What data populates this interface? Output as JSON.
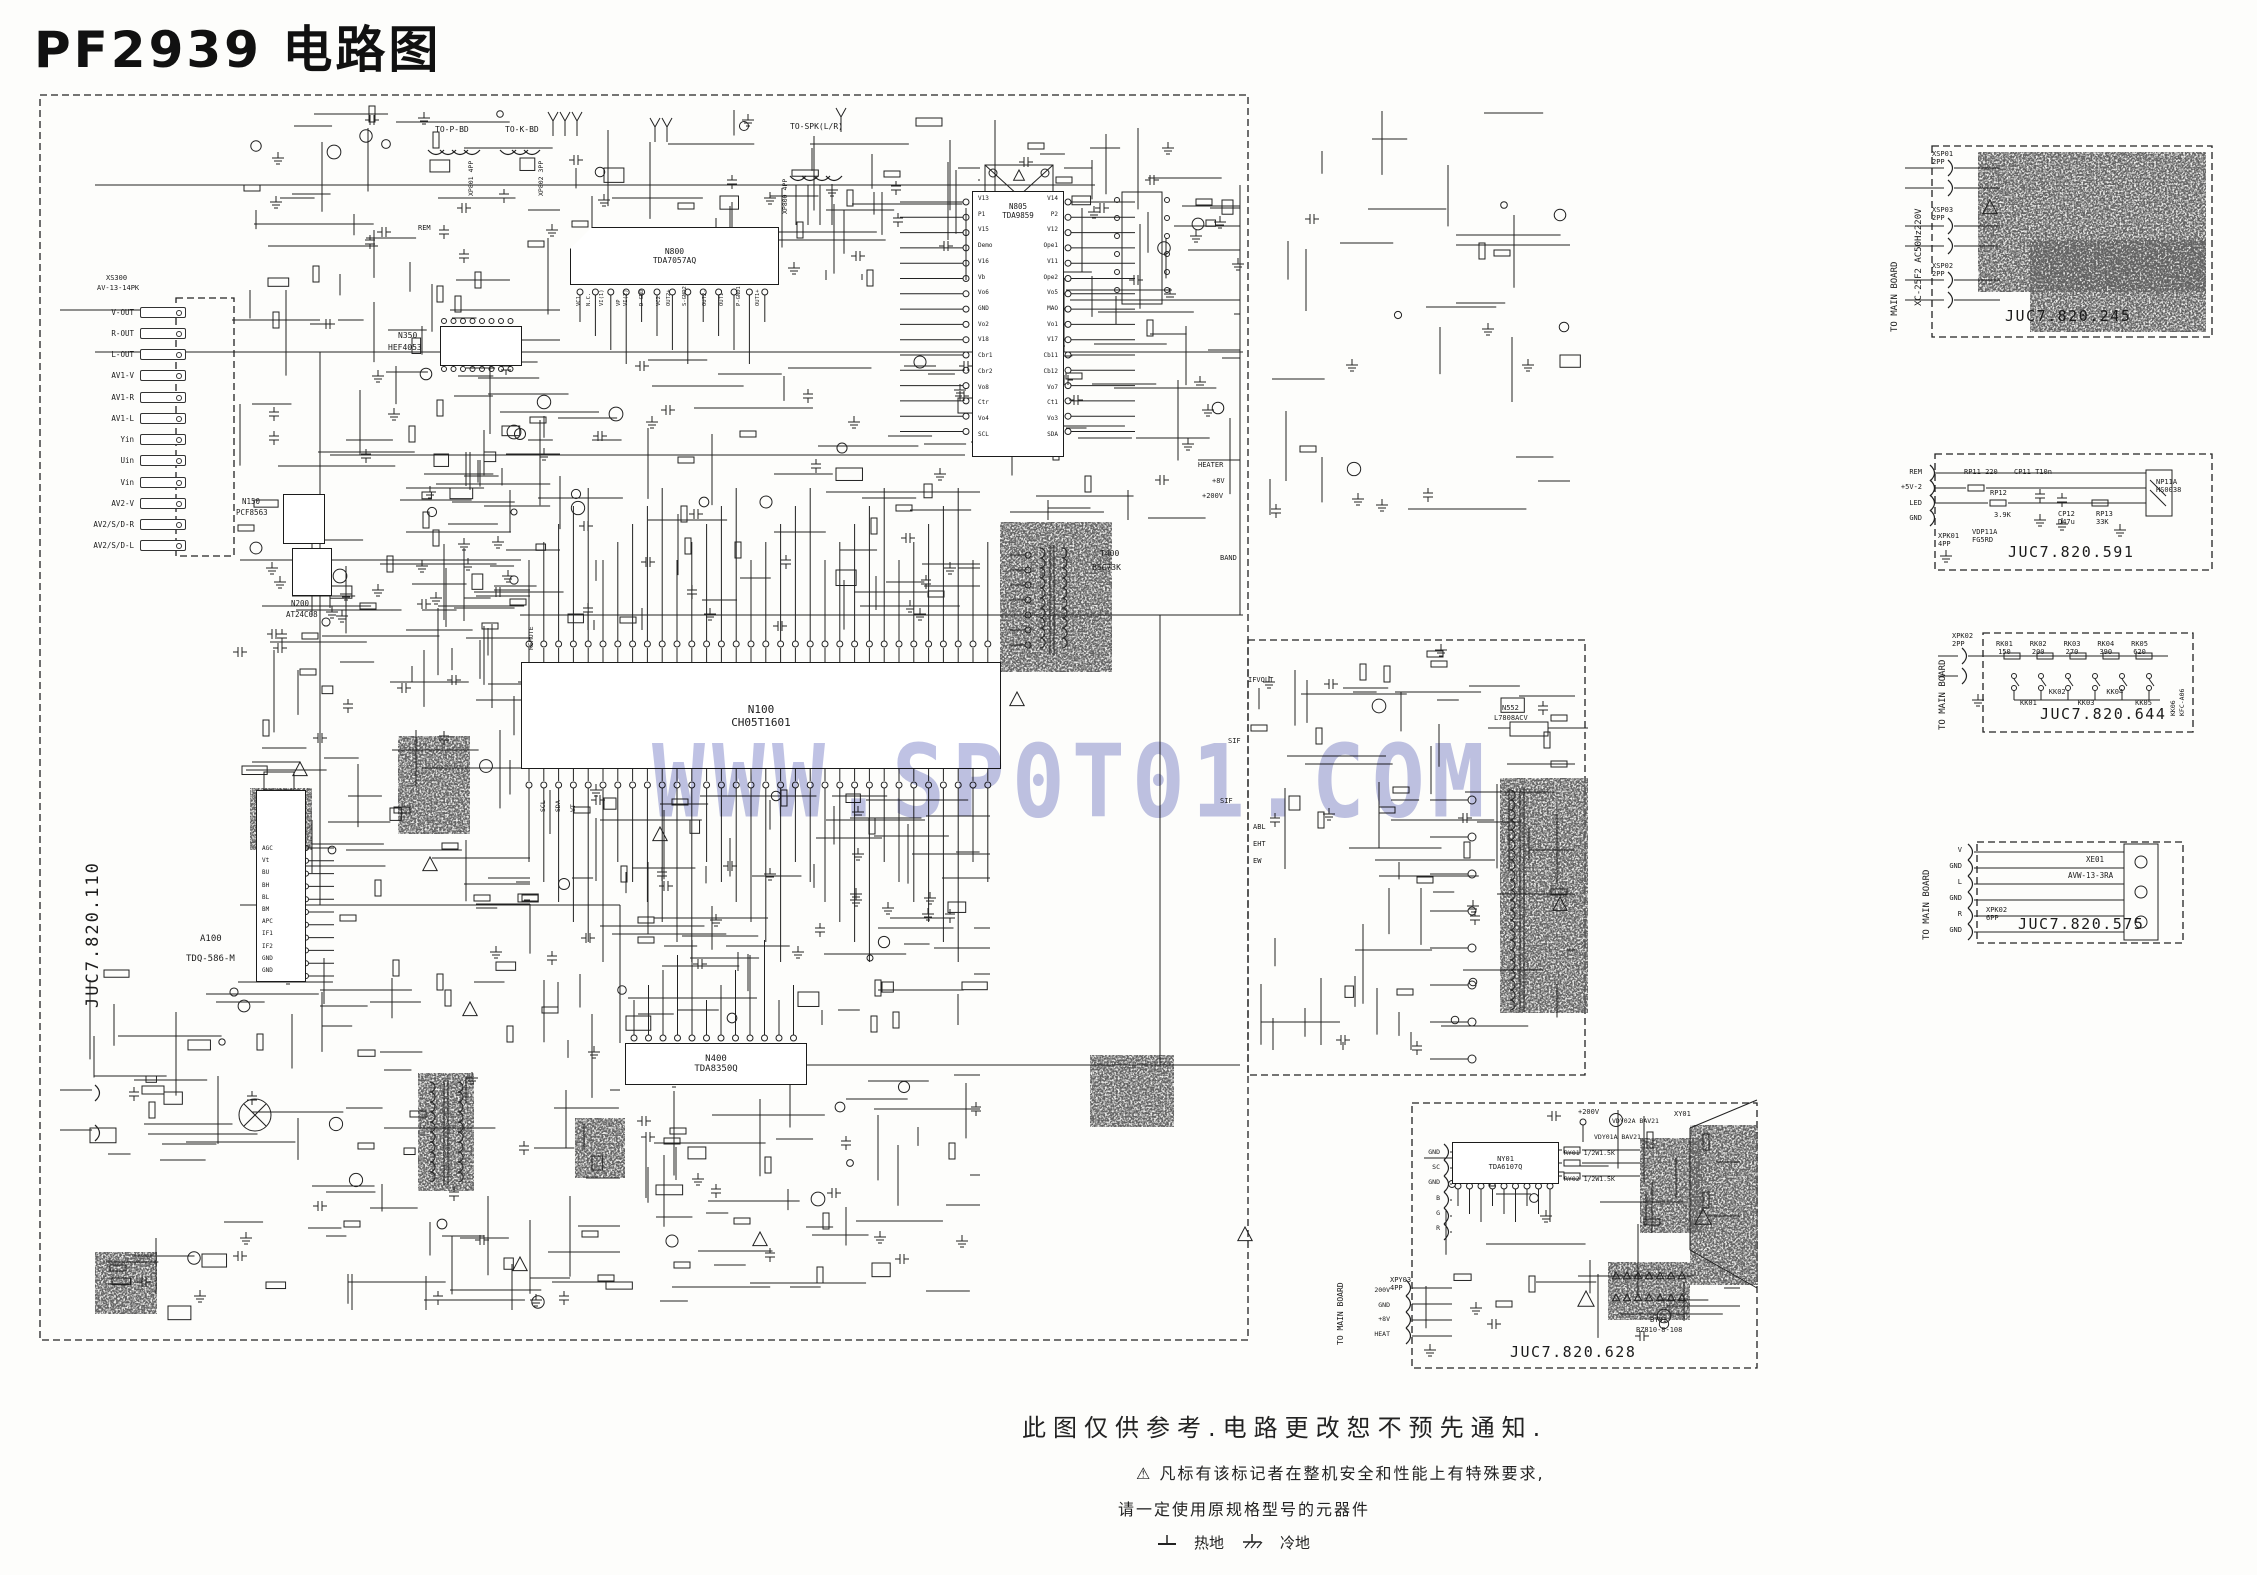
{
  "title": "PF2939 电路图",
  "watermark": "WWW.SP0T01.COM",
  "notes": {
    "disclaimer": "此图仅供参考.电路更改恕不预先通知.",
    "warning_symbol": "⚠",
    "warning_line1": "凡标有该标记者在整机安全和性能上有特殊要求,",
    "warning_line2": "请一定使用原规格型号的元器件",
    "ground_hot": "热地",
    "ground_cold": "冷地"
  },
  "main_board": {
    "code": "JUC7.820.110",
    "av_jack_panel": {
      "ref": "XS300",
      "type": "AV-13-14PK",
      "jacks": [
        "V-OUT",
        "R-OUT",
        "L-OUT",
        "AV1-V",
        "AV1-R",
        "AV1-L",
        "Yin",
        "Uin",
        "Vin",
        "AV2-V",
        "AV2/S/D-R",
        "AV2/S/D-L"
      ]
    },
    "tuner": {
      "ref": "A100",
      "part": "TDQ-586-M",
      "pins": [
        "AGC",
        "Vt",
        "BU",
        "BH",
        "BL",
        "BM",
        "APC",
        "IF1",
        "IF2",
        "GND",
        "GND"
      ]
    },
    "ics": {
      "n100": {
        "ref": "N100",
        "part": "CH05T1601"
      },
      "n805": {
        "ref": "N805",
        "part": "TDA9859",
        "pins_left": [
          "V13",
          "P1",
          "V15",
          "Demo",
          "V16",
          "Vb",
          "Vo6",
          "GND",
          "Vo2",
          "V18",
          "Cbr1",
          "Cbr2",
          "Vo8",
          "Ctr",
          "Vo4",
          "SCL"
        ],
        "pins_right": [
          "V14",
          "P2",
          "V12",
          "Ope1",
          "V11",
          "Ope2",
          "Vo5",
          "MAO",
          "Vo1",
          "V17",
          "Cb11",
          "Cb12",
          "Vo7",
          "Ct1",
          "Vo3",
          "SDA"
        ]
      },
      "n800": {
        "ref": "N800",
        "part": "TDA7057AQ",
        "pins": [
          "VC1",
          "N.C.",
          "VI(1)",
          "VP",
          "VI(2)",
          "D-GND",
          "VC2",
          "OUT2+",
          "S-GND2",
          "OUT2-",
          "OUT1-",
          "P-GND1",
          "OUT1+"
        ]
      },
      "n350": {
        "ref": "N350",
        "part": "HEF4053"
      },
      "n200": {
        "ref": "N200",
        "part": "AT24C08"
      },
      "n150": {
        "ref": "N150",
        "part": "PCF8563"
      },
      "n400": {
        "ref": "N400",
        "part": "TDA8350Q"
      },
      "n552": {
        "ref": "N552",
        "part": "L7808ACV"
      },
      "t400": {
        "ref": "T400",
        "part": "BSC73K"
      }
    },
    "top_connectors": [
      {
        "label": "TO-P-BD",
        "ref": "XP801",
        "type": "4PP"
      },
      {
        "label": "TO-K-BD",
        "ref": "XP802",
        "type": "3PP"
      },
      {
        "label": "TO-SPK(L/R)",
        "ref": "XP800",
        "type": "4PP"
      }
    ],
    "net_labels": [
      "HEATER",
      "+8V",
      "+200V",
      "IFVOLT",
      "SIF",
      "ABL",
      "EHT",
      "EW",
      "REM",
      "BAND"
    ],
    "mcu_pin_labels": [
      "REMOTE",
      "SCL",
      "SDA",
      "VT"
    ]
  },
  "sub_boards": {
    "power_input": {
      "code": "JUC7.820.245",
      "side_label": "TO MAIN BOARD",
      "mains_label": "XC-25F2 AC50Hz220V",
      "connectors": [
        {
          "ref": "XSP01",
          "type": "2PP"
        },
        {
          "ref": "XSP03",
          "type": "2PP"
        },
        {
          "ref": "XSP02",
          "type": "2PP"
        }
      ]
    },
    "ir_board": {
      "code": "JUC7.820.591",
      "connector": {
        "ref": "XPK01",
        "type": "4PP"
      },
      "signals": [
        "REM",
        "+5V-2",
        "LED",
        "GND"
      ],
      "parts": [
        {
          "ref": "RP11",
          "value": "220"
        },
        {
          "ref": "CP11",
          "value": "T10n"
        },
        {
          "ref": "RP12",
          "value": "3.9K"
        },
        {
          "ref": "VDP11A",
          "value": "FG5RD"
        },
        {
          "ref": "CP12",
          "value": "D47u"
        },
        {
          "ref": "RP13",
          "value": "33K"
        },
        {
          "ref": "NP11A",
          "value": "HS0038"
        }
      ]
    },
    "key_board": {
      "code": "JUC7.820.644",
      "side_label": "TO MAIN BOARD",
      "connector": {
        "ref": "XPK02",
        "type": "2PP"
      },
      "resistors": [
        {
          "ref": "RK01",
          "value": "150"
        },
        {
          "ref": "RK02",
          "value": "200"
        },
        {
          "ref": "RK03",
          "value": "270"
        },
        {
          "ref": "RK04",
          "value": "390"
        },
        {
          "ref": "RK05",
          "value": "620"
        }
      ],
      "keys": [
        "KK01",
        "KK02",
        "KK03",
        "KK04",
        "KK05"
      ],
      "key_block": {
        "ref": "KK06",
        "part": "KFC-A06"
      }
    },
    "av_board": {
      "code": "JUC7.820.575",
      "side_label": "TO MAIN BOARD",
      "connector": {
        "ref": "XPK02",
        "type": "6PP"
      },
      "signals": [
        "V",
        "GND",
        "L",
        "GND",
        "R",
        "GND"
      ],
      "jack": {
        "ref": "XE01",
        "part": "AVW-13-3RA"
      }
    },
    "crt_board": {
      "code": "JUC7.820.628",
      "side_label": "TO MAIN BOARD",
      "connector": {
        "ref": "XPY03",
        "type": "4PP"
      },
      "connector_signals": [
        "200V",
        "GND",
        "+8V",
        "HEAT"
      ],
      "input_signals": [
        "GND",
        "SC",
        "GND",
        "B",
        "G",
        "R"
      ],
      "video_amp": {
        "ref": "NY01",
        "part": "TDA6107Q"
      },
      "socket": {
        "ref": "BY01",
        "part": "BZ810-8-108"
      },
      "tube_label": "XY01",
      "net_label": "+200V",
      "parts": [
        {
          "ref": "VDY01A",
          "value": "BAV21"
        },
        {
          "ref": "VDY02A",
          "value": "BAV21"
        },
        {
          "ref": "RY01",
          "value": "1/2W1.5K"
        },
        {
          "ref": "RY02",
          "value": "1/2W1.5K"
        }
      ]
    }
  }
}
